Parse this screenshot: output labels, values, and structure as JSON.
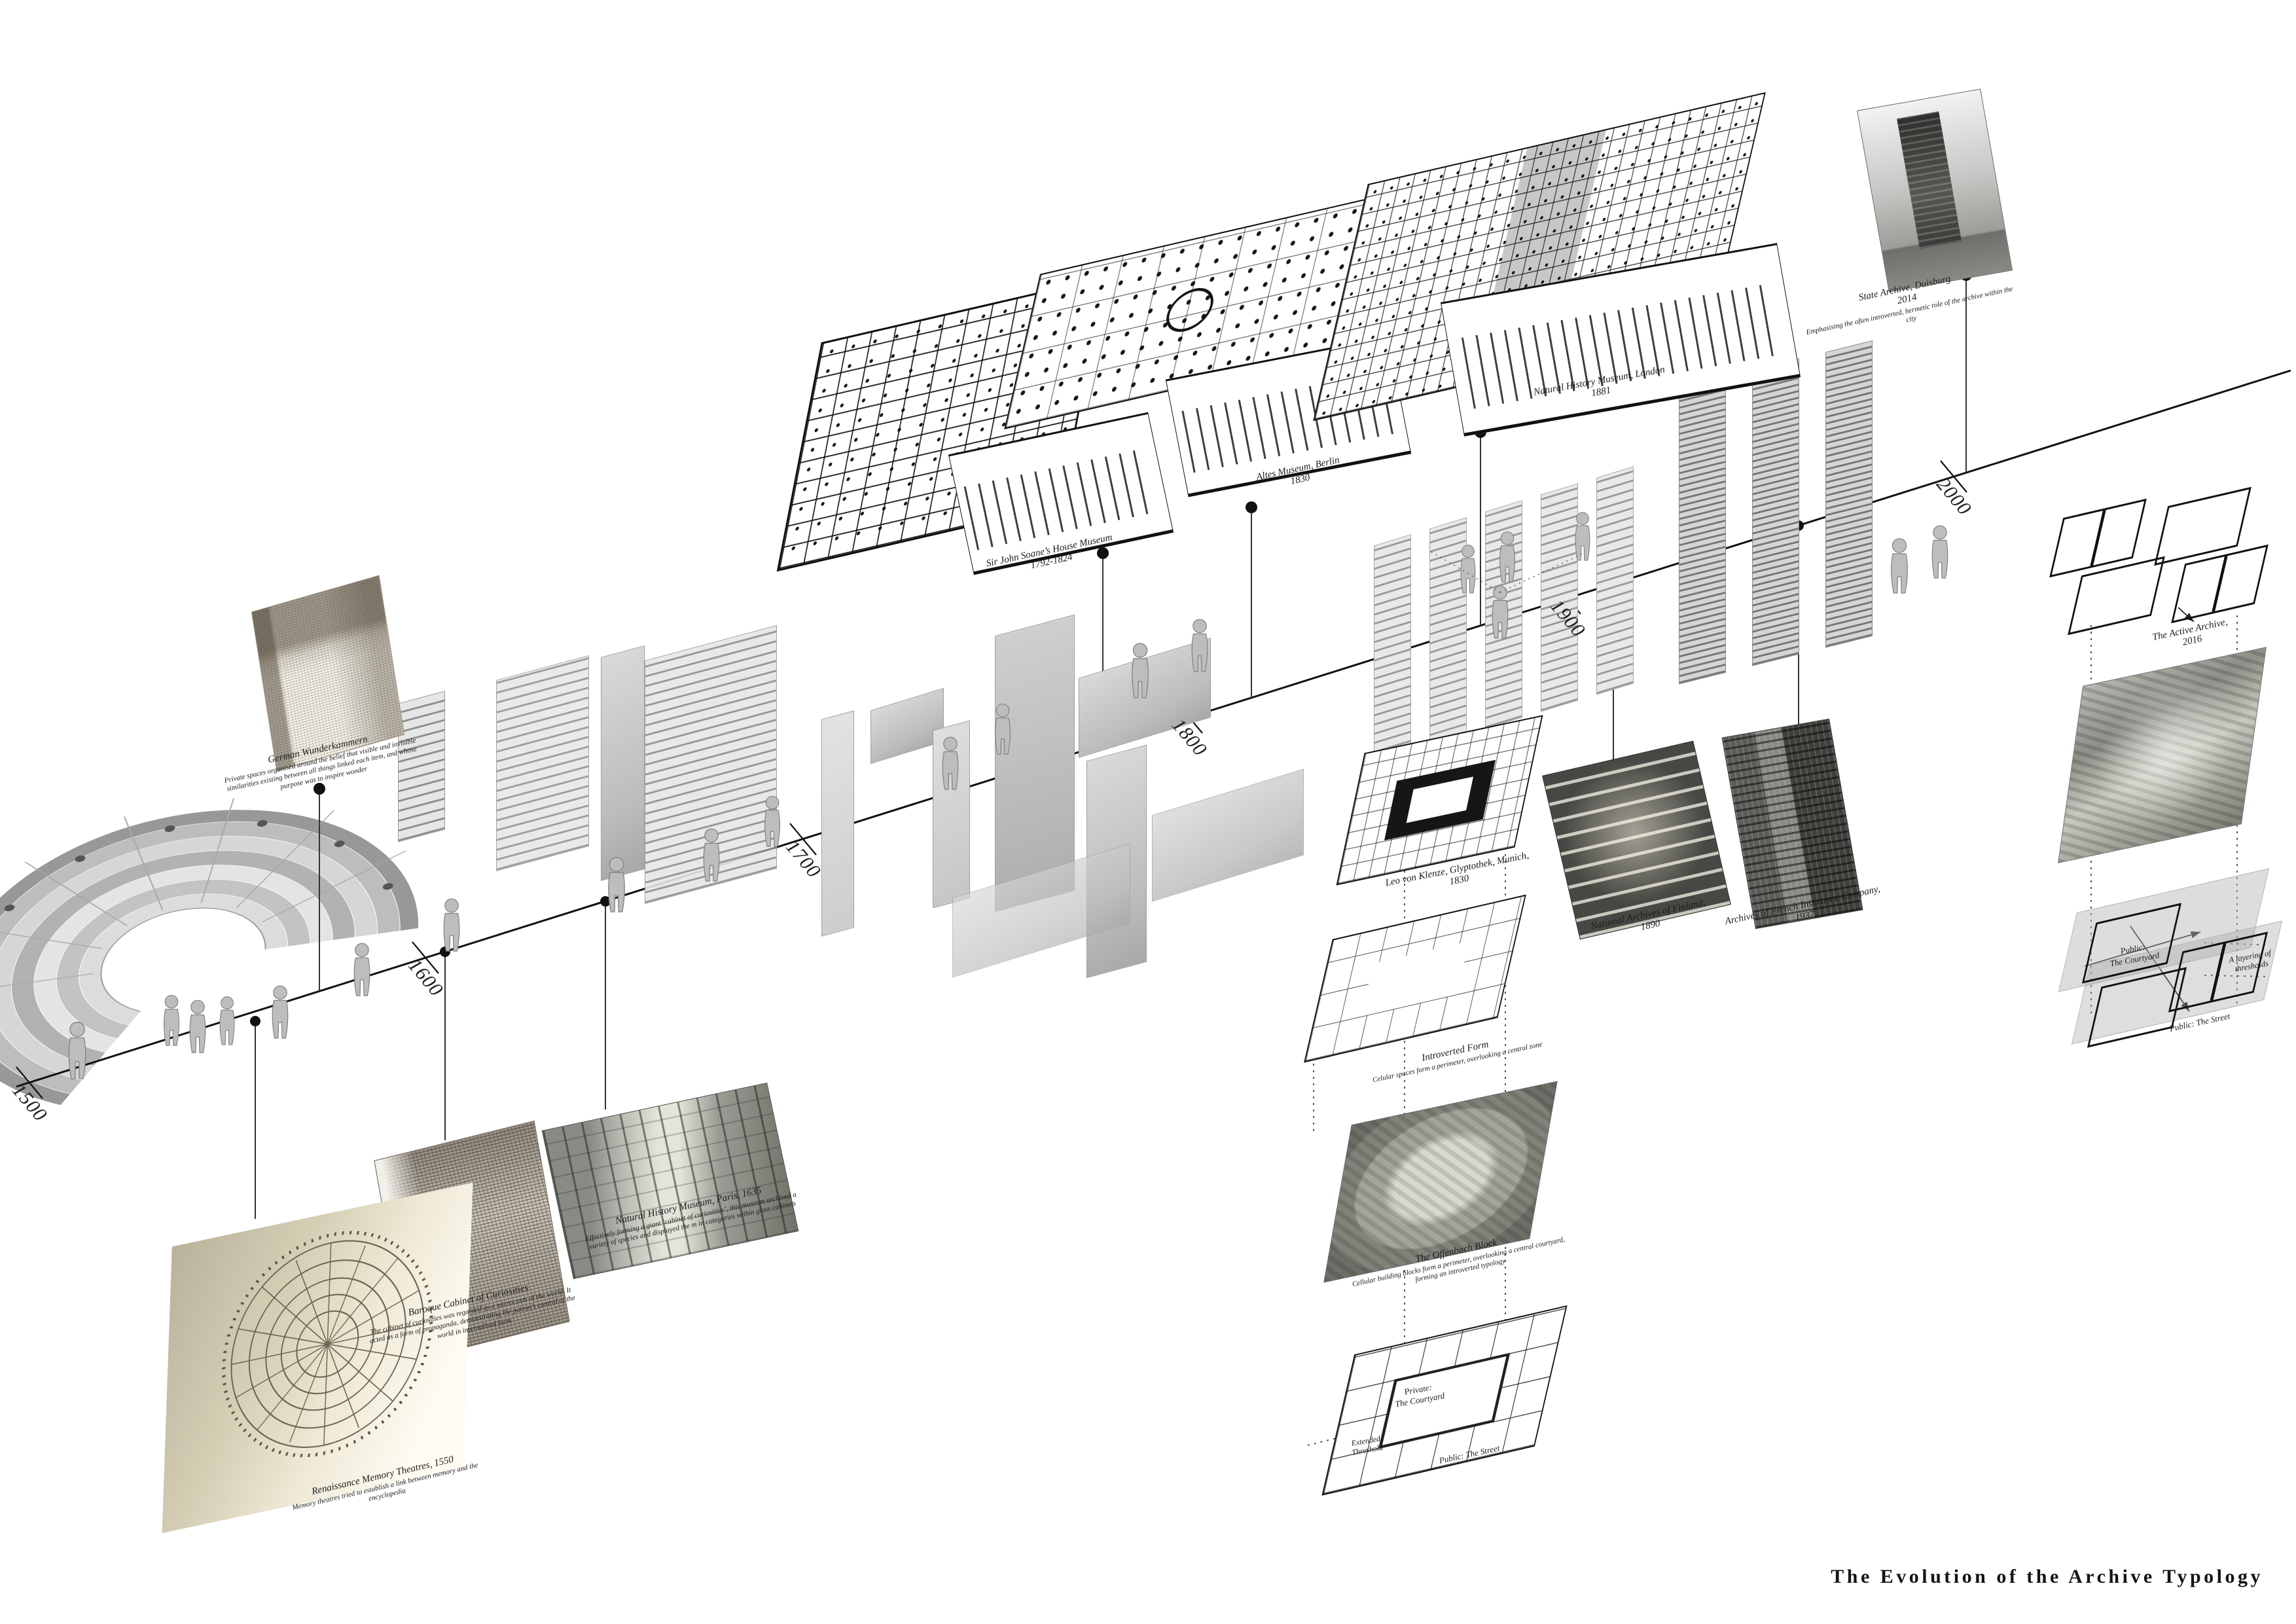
{
  "meta": {
    "title": "The Evolution of the Archive Typology"
  },
  "timeline": {
    "years": [
      "1500",
      "1600",
      "1700",
      "1800",
      "1900",
      "2000"
    ]
  },
  "entries": [
    {
      "id": "memory-theatres",
      "title": "Renaissance Memory Theatres, 1550",
      "description": "Memory theatres tried to establish a link between memory and the encyclopedia"
    },
    {
      "id": "wunderkammern",
      "title": "German Wunderkammern",
      "description": "Private spaces organised around the belief that visible and invisible similarities existing between all things linked each item, and whose purpose was to inspire wonder"
    },
    {
      "id": "baroque-cabinet",
      "title": "Baroque Cabinet of Curiosities",
      "description": "The cabinet of curiosities was regarded as a microcosm of the world. It acted as a form of propaganda, demonstrating the patron’s control of the world in internalised form"
    },
    {
      "id": "nhm-paris",
      "title": "Natural History Museum, Paris, 1635",
      "description": "Effectively forming a giant ‘cabinet of curiosities’, this museum archived a variety of species and displayed the m in categories within glass cabinets"
    },
    {
      "id": "soane-museum",
      "title": "Sir John Soane’s House Museum",
      "subtitle": "1792-1824"
    },
    {
      "id": "altes-museum",
      "title": "Altes Museum, Berlin",
      "subtitle": "1830"
    },
    {
      "id": "nhm-london",
      "title": "Natural History Museum, London",
      "subtitle": "1881"
    },
    {
      "id": "glyptothek",
      "title": "Leo von Klenze, Glyptothek, Munich,",
      "subtitle": "1830"
    },
    {
      "id": "finland-archives",
      "title": "National Archives of Finland,",
      "subtitle": "1890"
    },
    {
      "id": "french-insurance",
      "title": "Archives of French Insurance Company,",
      "subtitle": "1937"
    },
    {
      "id": "duisburg",
      "title": "State Archive, Duisburg",
      "subtitle": "2014",
      "description": "Emphasising the often introverted, hermetic role of the archive within the city"
    },
    {
      "id": "active-archive",
      "title": "The Active Archive,",
      "subtitle": "2016"
    },
    {
      "id": "introverted-form",
      "title": "Introverted Form",
      "description": "Celular spaces form a perimeter, overlooking a central zone"
    },
    {
      "id": "offenbach-block",
      "title": "The Offenbach Block",
      "description": "Cellular building blocks form a perimeter, overlooking a central courtyard, forming an introverted typology"
    }
  ],
  "annotations": {
    "private_line1": "Private:",
    "private_line2": "The Courtyard",
    "extended_line1": "Extended",
    "extended_line2": "Threshold",
    "street_mid": "Public: The Street",
    "public_line1": "Public:",
    "public_line2": "The Courtyard",
    "layering_line1": "A layering of",
    "layering_line2": "thresholds",
    "street_right": "Public: The Street"
  }
}
